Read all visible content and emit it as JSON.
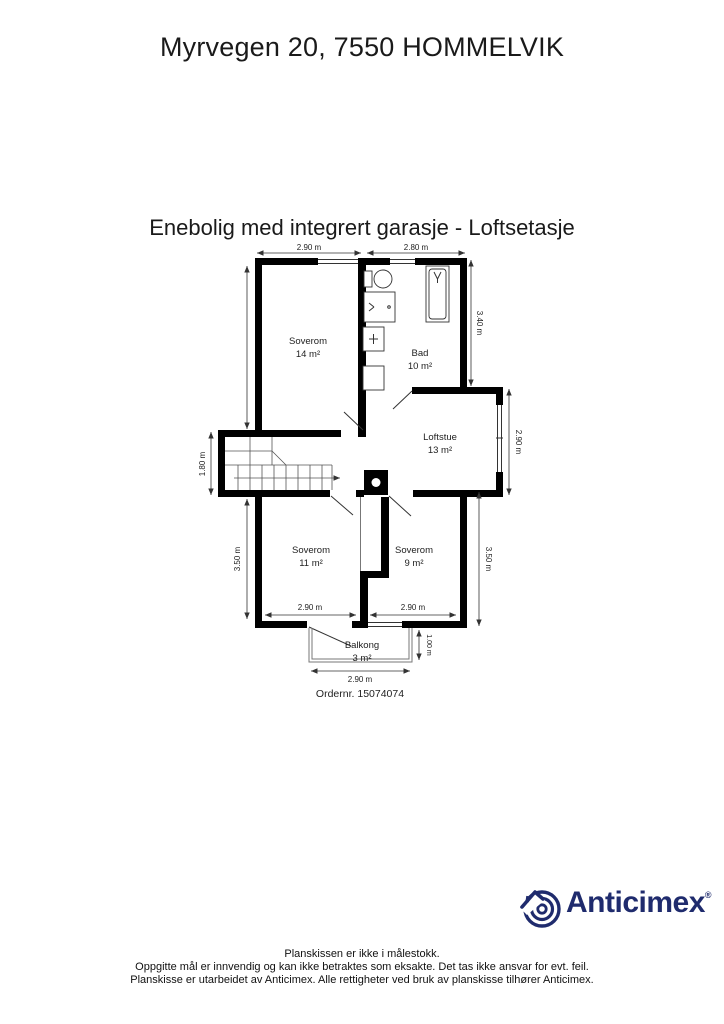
{
  "header": {
    "title": "Myrvegen 20, 7550 HOMMELVIK",
    "subtitle": "Enebolig med integrert garasje - Loftsetasje"
  },
  "plan": {
    "rooms": [
      {
        "name": "Soverom",
        "area": "14 m²"
      },
      {
        "name": "Bad",
        "area": "10 m²"
      },
      {
        "name": "Loftstue",
        "area": "13 m²"
      },
      {
        "name": "Soverom",
        "area": "11 m²"
      },
      {
        "name": "Soverom",
        "area": "9 m²"
      },
      {
        "name": "Balkong",
        "area": "3 m²"
      }
    ],
    "dims": {
      "top1": "2.90 m",
      "top2": "2.80 m",
      "right_bad": "3.40 m",
      "right_loftstue": "2.90 m",
      "right_soverom9": "3.50 m",
      "left_stair": "1.80 m",
      "left_soverom11": "3.50 m",
      "bottom_soverom11": "2.90 m",
      "bottom_soverom9": "2.90 m",
      "balcony_depth": "1.00 m",
      "balcony_width": "2.90 m"
    },
    "order": "Ordernr. 15074074"
  },
  "branding": {
    "logo_text": "Anticimex",
    "registered": "®",
    "brand_color": "#1f2b6d"
  },
  "footer": {
    "lines": [
      "Planskissen er ikke i målestokk.",
      "Oppgitte mål er innvendig og kan ikke betraktes som eksakte. Det tas ikke ansvar for evt. feil.",
      "Planskisse er utarbeidet av Anticimex. Alle rettigheter ved bruk av planskisse tilhører Anticimex."
    ]
  }
}
